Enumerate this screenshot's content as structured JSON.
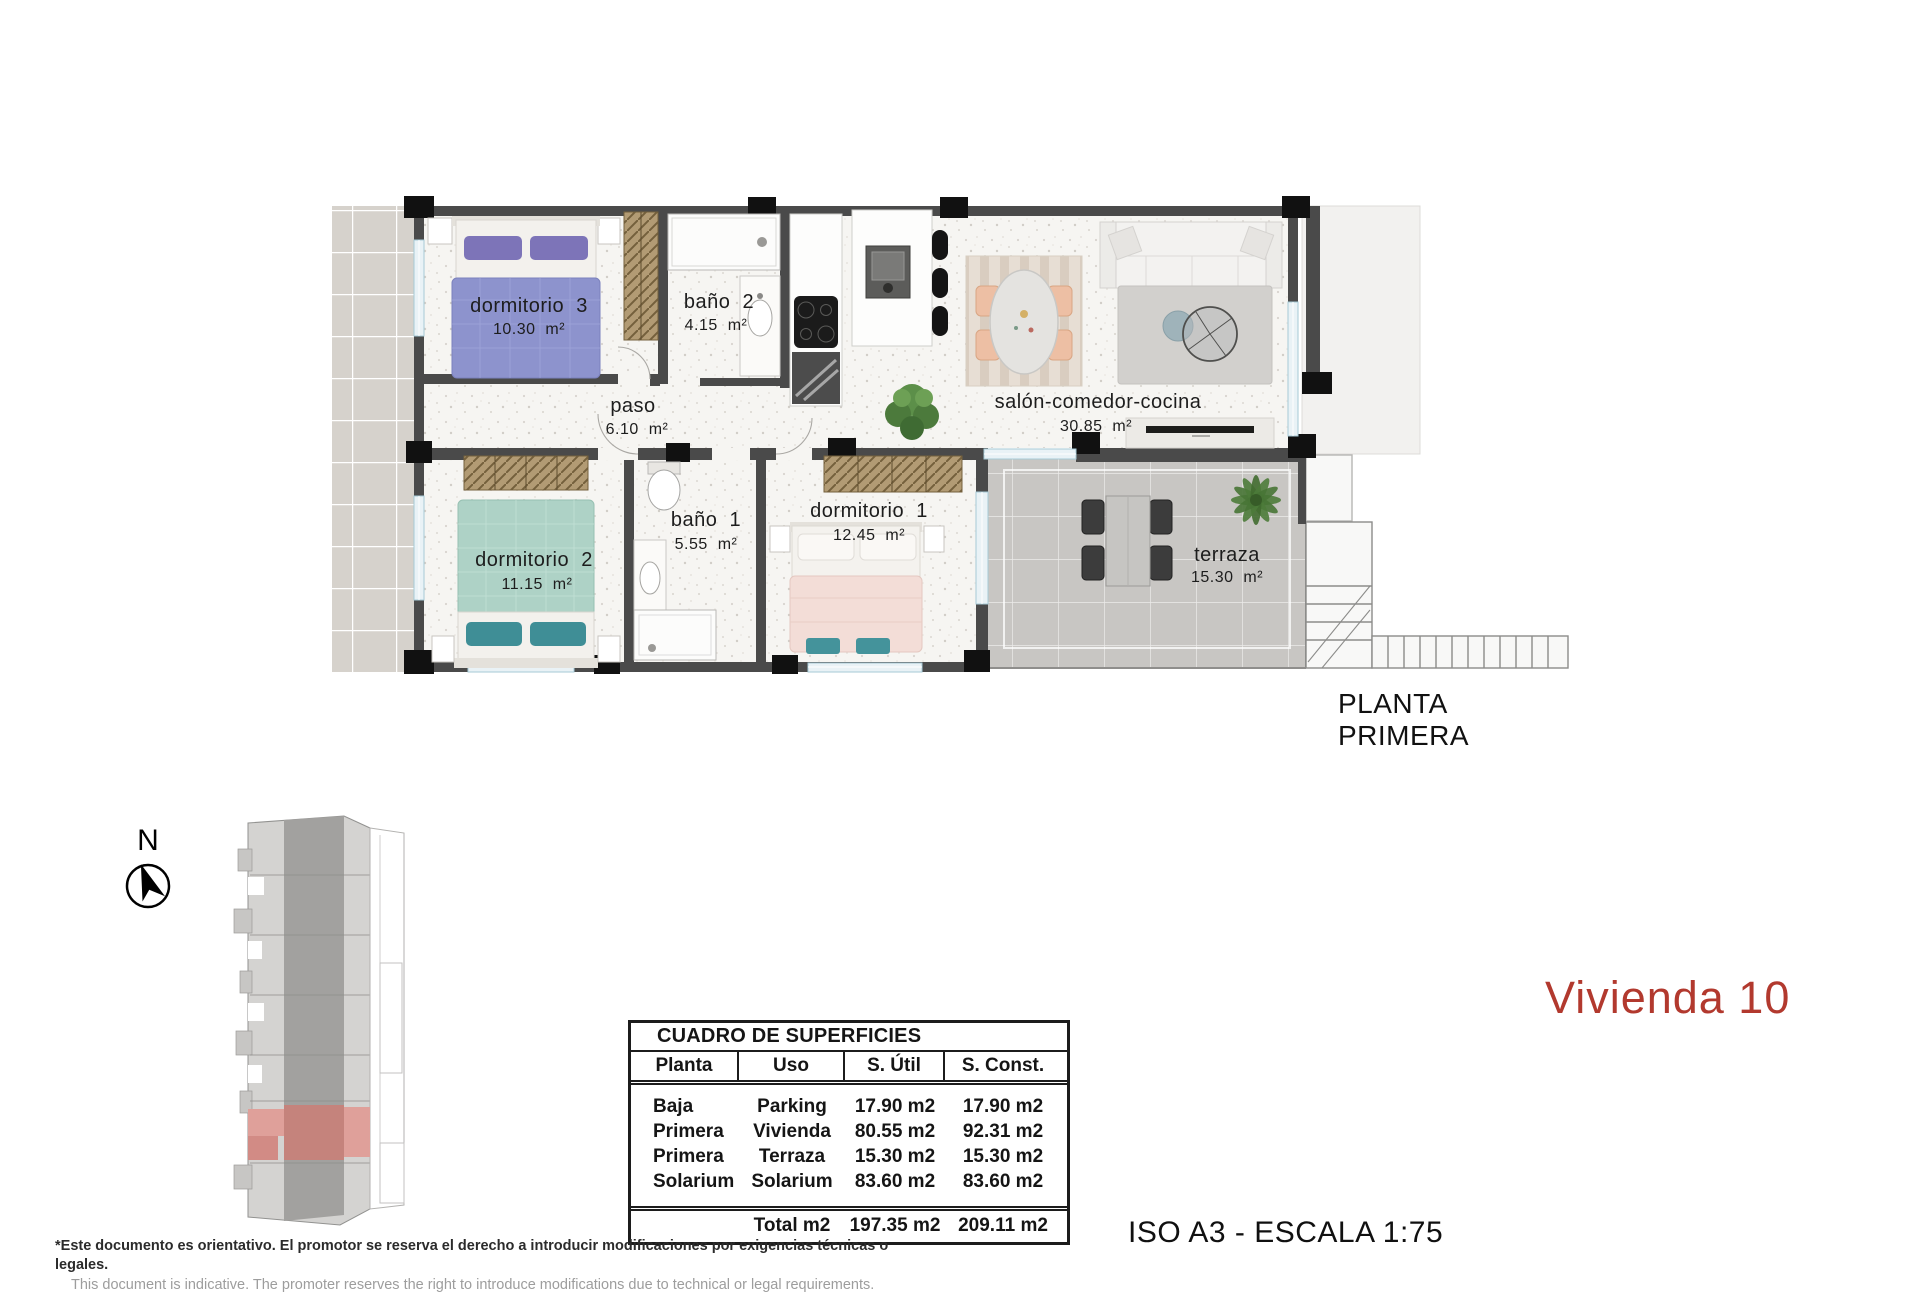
{
  "plan": {
    "floor_label": "PLANTA PRIMERA",
    "rooms": [
      {
        "name": "dormitorio  3",
        "area": "10.30  m²"
      },
      {
        "name": "baño  2",
        "area": "4.15  m²"
      },
      {
        "name": "paso",
        "area": "6.10  m²"
      },
      {
        "name": "salón-comedor-cocina",
        "area": "30.85  m²"
      },
      {
        "name": "dormitorio  2",
        "area": "11.15  m²"
      },
      {
        "name": "baño  1",
        "area": "5.55  m²"
      },
      {
        "name": "dormitorio  1",
        "area": "12.45  m²"
      },
      {
        "name": "terraza",
        "area": "15.30  m²"
      }
    ]
  },
  "compass": {
    "label": "N"
  },
  "surface_table": {
    "title": "CUADRO DE SUPERFICIES",
    "headers": [
      "Planta",
      "Uso",
      "S. Útil",
      "S. Const."
    ],
    "rows": [
      [
        "Baja",
        "Parking",
        "17.90 m2",
        "17.90 m2"
      ],
      [
        "Primera",
        "Vivienda",
        "80.55 m2",
        "92.31 m2"
      ],
      [
        "Primera",
        "Terraza",
        "15.30 m2",
        "15.30 m2"
      ],
      [
        "Solarium",
        "Solarium",
        "83.60 m2",
        "83.60 m2"
      ]
    ],
    "total_label": "Total m2",
    "total_util": "197.35 m2",
    "total_const": "209.11 m2"
  },
  "unit": {
    "title": "Vivienda 10",
    "accent_color": "#b2392e",
    "site_highlight_color": "#c5837c"
  },
  "scale_note": "ISO A3 - ESCALA 1:75",
  "disclaimer": {
    "es": "*Este documento es orientativo. El promotor se reserva el derecho a introducir modificaciones por exigencias técnicas o legales.",
    "en": "This document is indicative. The promoter reserves the right to introduce modifications due to technical or legal requirements."
  }
}
